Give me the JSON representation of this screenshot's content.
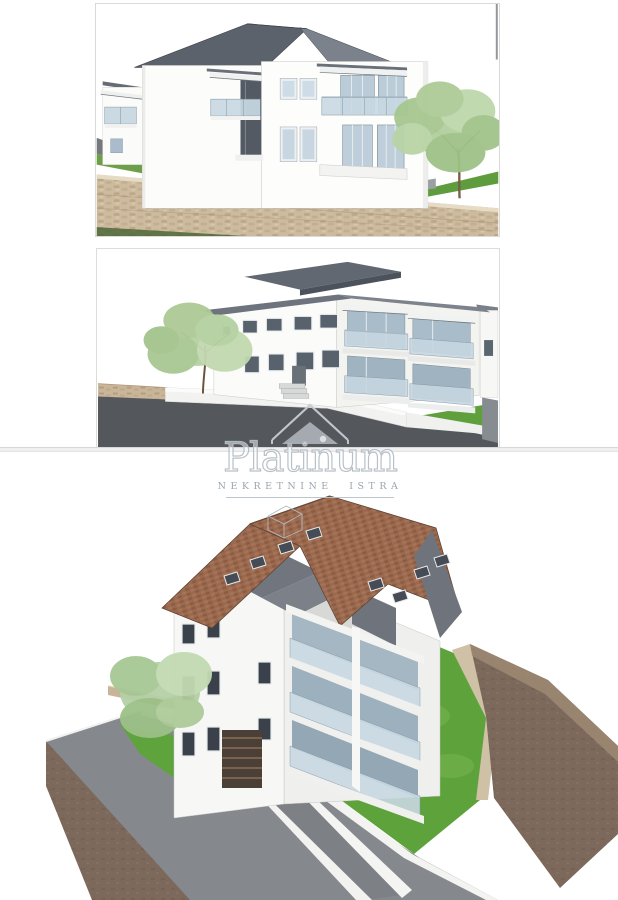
{
  "page": {
    "kind": "real-estate-photo-gallery",
    "background": "#ffffff"
  },
  "watermark": {
    "brand": "Platinum",
    "subtitle": "NEKRETNINE ISTRA",
    "logo": "house-outline-icon",
    "text_color": "#96a2ab",
    "stroke_color": "#b5bec6"
  },
  "divider": {
    "color": "#efefef"
  },
  "photos": [
    {
      "id": "side-elevation",
      "alt": "Architectural rendering - side elevation of a white two-storey apartment building with dark grey pitched roof, glass balconies, stone retaining wall, lawn and a tree on the right"
    },
    {
      "id": "street-perspective",
      "alt": "Architectural rendering - street level perspective of the white apartment building with dark grey roof slabs, two floors of glass balconies, tree, white boundary wall and asphalt road"
    },
    {
      "id": "aerial-view",
      "alt": "Architectural rendering - aerial view of the building with terracotta tiled roof, roof windows, rooftop terrace, stacked white balconies, green lawn, driveway ramp to garage and brown terrain block"
    }
  ],
  "colors": {
    "wall_white": "#f8f8f6",
    "roof_dark_grey": "#5c626c",
    "roof_terracotta": "#9b6a4e",
    "glass": "#c9d9e3",
    "grass": "#5da23b",
    "road_dark": "#54585d",
    "road_light": "#85898e",
    "earth_brown": "#7c695b",
    "stone_tan": "#cbb79b"
  }
}
